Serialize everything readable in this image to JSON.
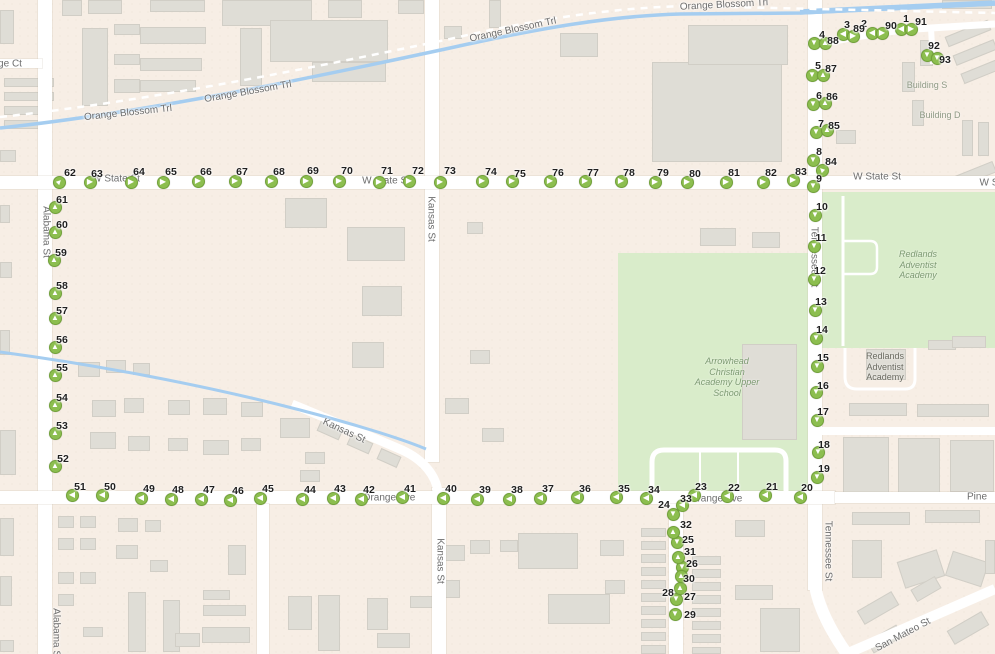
{
  "map": {
    "colors": {
      "land": "#f7eee5",
      "road": "#ffffff",
      "building": "#dfddd6",
      "park": "#d9ecca",
      "water": "#a5cdf0",
      "marker_fill": "#8cbe4f",
      "marker_border": "#72a23a",
      "marker_arrow": "#ffffff",
      "marker_number_text": "#1f1f1f",
      "street_label_text": "#6d6d6d",
      "green_place_text": "#7d9a72",
      "gray_place_text": "#69695f"
    },
    "street_labels": [
      {
        "text": "ge Ct",
        "x": 10,
        "y": 64,
        "rot": 0
      },
      {
        "text": "Orange Blossom Trl",
        "x": 128,
        "y": 113,
        "rot": -6
      },
      {
        "text": "Orange Blossom Trl",
        "x": 248,
        "y": 92,
        "rot": -10
      },
      {
        "text": "Orange Blossom Trl",
        "x": 513,
        "y": 30,
        "rot": -12
      },
      {
        "text": "Orange Blossom Trl",
        "x": 724,
        "y": 5,
        "rot": -3
      },
      {
        "text": "W State St",
        "x": 116,
        "y": 179,
        "rot": 0
      },
      {
        "text": "W State St",
        "x": 386,
        "y": 181,
        "rot": 0
      },
      {
        "text": "W State St",
        "x": 877,
        "y": 177,
        "rot": 0
      },
      {
        "text": "W S",
        "x": 989,
        "y": 183,
        "rot": 0
      },
      {
        "text": "Alabama St",
        "x": 46,
        "y": 232,
        "rot": 90
      },
      {
        "text": "Alabama St",
        "x": 56,
        "y": 634,
        "rot": 90
      },
      {
        "text": "Kansas St",
        "x": 431,
        "y": 219,
        "rot": 90
      },
      {
        "text": "Kansas St",
        "x": 344,
        "y": 431,
        "rot": 25
      },
      {
        "text": "Kansas St",
        "x": 440,
        "y": 561,
        "rot": 90
      },
      {
        "text": "Tennessee St",
        "x": 814,
        "y": 257,
        "rot": 90
      },
      {
        "text": "Tennessee St",
        "x": 828,
        "y": 551,
        "rot": 90
      },
      {
        "text": "Orange Ave",
        "x": 389,
        "y": 498,
        "rot": 0
      },
      {
        "text": "Orange Ave",
        "x": 716,
        "y": 499,
        "rot": 0
      },
      {
        "text": "Pine",
        "x": 977,
        "y": 497,
        "rot": 0
      },
      {
        "text": "San Mateo St",
        "x": 903,
        "y": 635,
        "rot": -28
      }
    ],
    "place_labels": [
      {
        "lines": [
          "Building S"
        ],
        "x": 927,
        "y": 80,
        "color": "#8f9a85",
        "italic": false
      },
      {
        "lines": [
          "Building D"
        ],
        "x": 940,
        "y": 110,
        "color": "#8f9a85",
        "italic": false
      },
      {
        "lines": [
          "Redlands",
          "Adventist",
          "Academy"
        ],
        "x": 918,
        "y": 249,
        "color": "#7d9a72",
        "italic": true
      },
      {
        "lines": [
          "Arrowhead",
          "Christian",
          "Academy Upper",
          "School"
        ],
        "x": 727,
        "y": 356,
        "color": "#7d9a72",
        "italic": true
      },
      {
        "lines": [
          "Redlands",
          "Adventist",
          "Academy"
        ],
        "x": 885,
        "y": 351,
        "color": "#69695f",
        "italic": false
      }
    ],
    "marker_fields": [
      "number",
      "x",
      "y",
      "direction",
      "label_x",
      "label_y"
    ],
    "markers": [
      [
        1,
        901,
        29,
        "left",
        906,
        19
      ],
      [
        91,
        911,
        29,
        "right",
        921,
        22
      ],
      [
        2,
        872,
        33,
        "left",
        864,
        24
      ],
      [
        90,
        882,
        33,
        "right",
        891,
        26
      ],
      [
        3,
        843,
        34,
        "left",
        847,
        25
      ],
      [
        89,
        853,
        36,
        "right",
        859,
        29
      ],
      [
        4,
        814,
        43,
        "down",
        822,
        35
      ],
      [
        88,
        825,
        43,
        "up",
        833,
        41
      ],
      [
        5,
        812,
        75,
        "down",
        818,
        66
      ],
      [
        87,
        823,
        75,
        "up",
        831,
        69
      ],
      [
        6,
        813,
        104,
        "down",
        819,
        96
      ],
      [
        86,
        825,
        103,
        "up",
        832,
        97
      ],
      [
        7,
        816,
        132,
        "down",
        821,
        124
      ],
      [
        85,
        827,
        130,
        "up",
        834,
        126
      ],
      [
        8,
        813,
        160,
        "down",
        819,
        152
      ],
      [
        84,
        822,
        170,
        "up-left",
        831,
        162
      ],
      [
        92,
        927,
        55,
        "down",
        934,
        46
      ],
      [
        93,
        937,
        58,
        "down",
        945,
        60
      ],
      [
        9,
        813,
        186,
        "down",
        819,
        179
      ],
      [
        10,
        815,
        215,
        "down",
        822,
        207
      ],
      [
        11,
        814,
        246,
        "down",
        821,
        238
      ],
      [
        12,
        814,
        279,
        "down",
        820,
        271
      ],
      [
        13,
        815,
        310,
        "down",
        821,
        302
      ],
      [
        14,
        816,
        338,
        "down",
        822,
        330
      ],
      [
        15,
        817,
        366,
        "down",
        823,
        358
      ],
      [
        16,
        816,
        392,
        "down",
        823,
        386
      ],
      [
        17,
        817,
        420,
        "down",
        823,
        412
      ],
      [
        18,
        818,
        452,
        "down",
        824,
        445
      ],
      [
        19,
        817,
        477,
        "down",
        824,
        469
      ],
      [
        20,
        800,
        497,
        "left",
        807,
        488
      ],
      [
        21,
        765,
        495,
        "left",
        772,
        487
      ],
      [
        22,
        727,
        496,
        "left",
        734,
        488
      ],
      [
        23,
        694,
        495,
        "left",
        701,
        487
      ],
      [
        24,
        673,
        514,
        "down",
        664,
        505
      ],
      [
        25,
        677,
        542,
        "down",
        688,
        540
      ],
      [
        26,
        682,
        567,
        "down",
        692,
        564
      ],
      [
        27,
        676,
        599,
        "down",
        690,
        597
      ],
      [
        28,
        680,
        588,
        "up",
        668,
        593
      ],
      [
        29,
        675,
        614,
        "down",
        690,
        615
      ],
      [
        30,
        681,
        576,
        "up",
        689,
        579
      ],
      [
        31,
        678,
        557,
        "up",
        690,
        552
      ],
      [
        32,
        673,
        532,
        "up",
        686,
        525
      ],
      [
        33,
        682,
        505,
        "left",
        686,
        499
      ],
      [
        34,
        646,
        498,
        "left",
        654,
        490
      ],
      [
        35,
        616,
        497,
        "left",
        624,
        489
      ],
      [
        36,
        577,
        497,
        "left",
        585,
        489
      ],
      [
        37,
        540,
        498,
        "left",
        548,
        489
      ],
      [
        38,
        509,
        499,
        "left",
        517,
        490
      ],
      [
        39,
        477,
        499,
        "left",
        485,
        490
      ],
      [
        40,
        443,
        498,
        "left",
        451,
        489
      ],
      [
        41,
        402,
        497,
        "left",
        410,
        489
      ],
      [
        42,
        361,
        499,
        "left",
        369,
        490
      ],
      [
        43,
        333,
        498,
        "left",
        340,
        489
      ],
      [
        44,
        302,
        499,
        "left",
        310,
        490
      ],
      [
        45,
        260,
        498,
        "left",
        268,
        489
      ],
      [
        46,
        230,
        500,
        "left",
        238,
        491
      ],
      [
        47,
        201,
        499,
        "left",
        209,
        490
      ],
      [
        48,
        171,
        499,
        "left",
        178,
        490
      ],
      [
        49,
        141,
        498,
        "left",
        149,
        489
      ],
      [
        50,
        102,
        495,
        "left",
        110,
        487
      ],
      [
        51,
        72,
        495,
        "left",
        80,
        487
      ],
      [
        52,
        55,
        466,
        "up",
        63,
        459
      ],
      [
        53,
        55,
        433,
        "up",
        62,
        426
      ],
      [
        54,
        55,
        405,
        "up",
        62,
        398
      ],
      [
        55,
        55,
        375,
        "up",
        62,
        368
      ],
      [
        56,
        55,
        347,
        "up",
        62,
        340
      ],
      [
        57,
        55,
        318,
        "up",
        62,
        311
      ],
      [
        58,
        55,
        293,
        "up",
        62,
        286
      ],
      [
        59,
        54,
        260,
        "up",
        61,
        253
      ],
      [
        60,
        55,
        232,
        "up",
        62,
        225
      ],
      [
        61,
        55,
        207,
        "up",
        62,
        200
      ],
      [
        62,
        59,
        182,
        "up-right",
        70,
        173
      ],
      [
        63,
        90,
        182,
        "right",
        97,
        174
      ],
      [
        64,
        131,
        182,
        "right",
        139,
        172
      ],
      [
        65,
        163,
        182,
        "right",
        171,
        172
      ],
      [
        66,
        198,
        181,
        "right",
        206,
        172
      ],
      [
        67,
        235,
        181,
        "right",
        242,
        172
      ],
      [
        68,
        271,
        181,
        "right",
        279,
        172
      ],
      [
        69,
        306,
        181,
        "right",
        313,
        171
      ],
      [
        70,
        339,
        181,
        "right",
        347,
        171
      ],
      [
        71,
        379,
        182,
        "right",
        387,
        171
      ],
      [
        72,
        409,
        181,
        "right",
        418,
        171
      ],
      [
        73,
        440,
        182,
        "right",
        450,
        171
      ],
      [
        74,
        482,
        181,
        "right",
        491,
        172
      ],
      [
        75,
        512,
        181,
        "right",
        520,
        174
      ],
      [
        76,
        550,
        181,
        "right",
        558,
        173
      ],
      [
        77,
        585,
        181,
        "right",
        593,
        173
      ],
      [
        78,
        621,
        181,
        "right",
        629,
        173
      ],
      [
        79,
        655,
        182,
        "right",
        663,
        173
      ],
      [
        80,
        687,
        182,
        "right",
        695,
        174
      ],
      [
        81,
        726,
        182,
        "right",
        734,
        173
      ],
      [
        82,
        763,
        182,
        "right",
        771,
        173
      ],
      [
        83,
        793,
        180,
        "right",
        801,
        172
      ]
    ]
  }
}
